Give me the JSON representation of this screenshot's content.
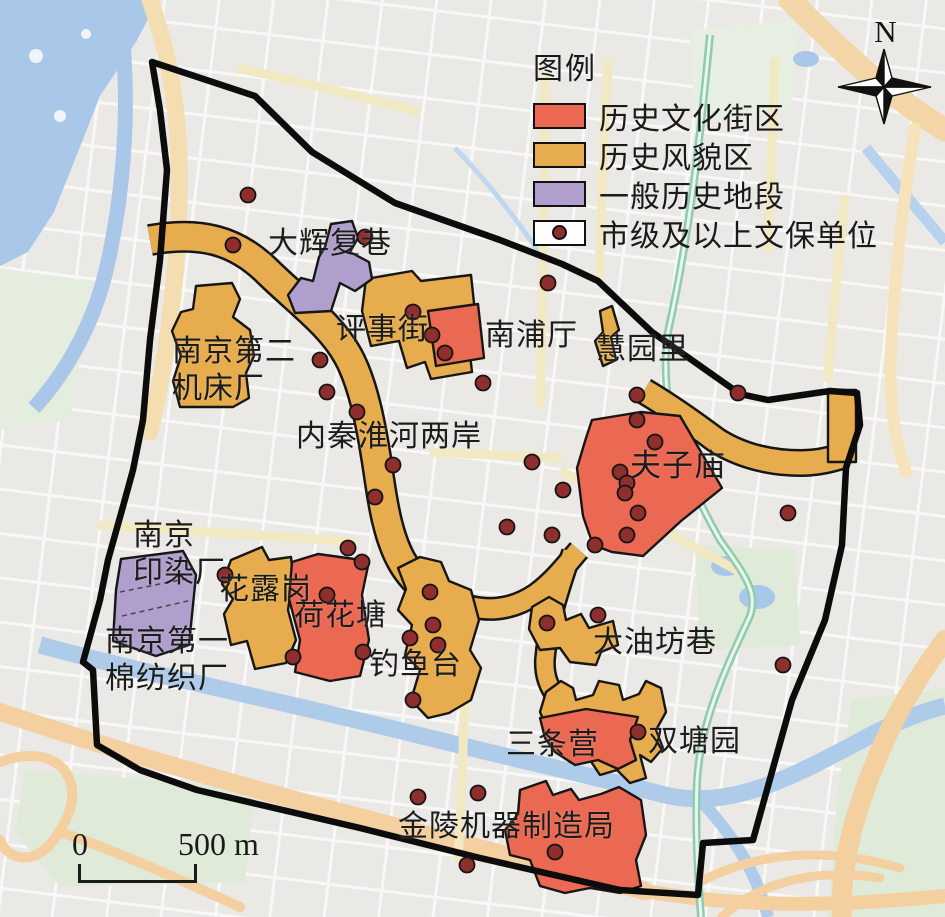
{
  "colors": {
    "historic_block": "#EB6852",
    "historic_style": "#E6AC4D",
    "general_historic": "#B09FCC",
    "heritage_dot": "#8E2F2D"
  },
  "legend": {
    "title": "图例",
    "items": [
      {
        "label": "历史文化街区",
        "color_key": "historic_block",
        "type": "fill"
      },
      {
        "label": "历史风貌区",
        "color_key": "historic_style",
        "type": "fill"
      },
      {
        "label": "一般历史地段",
        "color_key": "general_historic",
        "type": "fill"
      },
      {
        "label": "市级及以上文保单位",
        "color_key": "heritage_dot",
        "type": "dot"
      }
    ]
  },
  "compass": {
    "label": "N"
  },
  "scale_bar": {
    "start": "0",
    "end": "500 m"
  },
  "map": {
    "area_labels": [
      {
        "name": "dahuifuxiang",
        "lines": [
          "大辉复巷"
        ],
        "x": 268,
        "y": 226,
        "size": 30
      },
      {
        "name": "nanjing-no2-machine-tool-works",
        "lines": [
          "南京第二",
          "机床厂"
        ],
        "x": 172,
        "y": 334,
        "size": 30
      },
      {
        "name": "pingshijie",
        "lines": [
          "评事街"
        ],
        "x": 336,
        "y": 312,
        "size": 30
      },
      {
        "name": "nanputing",
        "lines": [
          "南浦厅"
        ],
        "x": 485,
        "y": 318,
        "size": 30
      },
      {
        "name": "huiyuanli",
        "lines": [
          "慧园里"
        ],
        "x": 596,
        "y": 332,
        "size": 30
      },
      {
        "name": "inner-qinhuai-river-banks",
        "lines": [
          "内秦淮河两岸"
        ],
        "x": 296,
        "y": 419,
        "size": 30
      },
      {
        "name": "fuzimiao",
        "lines": [
          "夫子庙"
        ],
        "x": 630,
        "y": 447,
        "size": 31
      },
      {
        "name": "nanjing-dyeing-factory",
        "lines": [
          "南京",
          "印染厂"
        ],
        "x": 133,
        "y": 518,
        "size": 30
      },
      {
        "name": "hualugang",
        "lines": [
          "花露岗"
        ],
        "x": 219,
        "y": 572,
        "size": 30
      },
      {
        "name": "hehuatang",
        "lines": [
          "荷花塘"
        ],
        "x": 294,
        "y": 598,
        "size": 30
      },
      {
        "name": "nanjing-no1-cotton-mill",
        "lines": [
          "南京第一",
          "棉纺织厂"
        ],
        "x": 105,
        "y": 624,
        "size": 30
      },
      {
        "name": "diaoyutai",
        "lines": [
          "钓鱼台"
        ],
        "x": 369,
        "y": 647,
        "size": 30
      },
      {
        "name": "dayoufangxiang",
        "lines": [
          "大油坊巷"
        ],
        "x": 593,
        "y": 625,
        "size": 30
      },
      {
        "name": "santiaoying",
        "lines": [
          "三条营"
        ],
        "x": 506,
        "y": 727,
        "size": 30
      },
      {
        "name": "shuangtangyuan",
        "lines": [
          "双塘园"
        ],
        "x": 648,
        "y": 724,
        "size": 30
      },
      {
        "name": "jinling-machinery-bureau",
        "lines": [
          "金陵机器制造局"
        ],
        "x": 398,
        "y": 809,
        "size": 30
      }
    ],
    "heritage_sites": [
      {
        "x": 248,
        "y": 195
      },
      {
        "x": 233,
        "y": 245
      },
      {
        "x": 365,
        "y": 237
      },
      {
        "x": 548,
        "y": 283
      },
      {
        "x": 413,
        "y": 312
      },
      {
        "x": 432,
        "y": 335
      },
      {
        "x": 445,
        "y": 353
      },
      {
        "x": 320,
        "y": 360
      },
      {
        "x": 327,
        "y": 392
      },
      {
        "x": 357,
        "y": 412
      },
      {
        "x": 483,
        "y": 383
      },
      {
        "x": 393,
        "y": 465
      },
      {
        "x": 375,
        "y": 497
      },
      {
        "x": 532,
        "y": 462
      },
      {
        "x": 563,
        "y": 490
      },
      {
        "x": 348,
        "y": 548
      },
      {
        "x": 362,
        "y": 562
      },
      {
        "x": 507,
        "y": 527
      },
      {
        "x": 552,
        "y": 535
      },
      {
        "x": 637,
        "y": 395
      },
      {
        "x": 738,
        "y": 393
      },
      {
        "x": 637,
        "y": 420
      },
      {
        "x": 655,
        "y": 442
      },
      {
        "x": 620,
        "y": 472
      },
      {
        "x": 627,
        "y": 483
      },
      {
        "x": 625,
        "y": 493
      },
      {
        "x": 638,
        "y": 513
      },
      {
        "x": 627,
        "y": 535
      },
      {
        "x": 595,
        "y": 545
      },
      {
        "x": 788,
        "y": 513
      },
      {
        "x": 225,
        "y": 575
      },
      {
        "x": 327,
        "y": 595
      },
      {
        "x": 293,
        "y": 657
      },
      {
        "x": 363,
        "y": 652
      },
      {
        "x": 430,
        "y": 592
      },
      {
        "x": 433,
        "y": 625
      },
      {
        "x": 410,
        "y": 638
      },
      {
        "x": 438,
        "y": 645
      },
      {
        "x": 547,
        "y": 623
      },
      {
        "x": 598,
        "y": 615
      },
      {
        "x": 783,
        "y": 665
      },
      {
        "x": 638,
        "y": 732
      },
      {
        "x": 413,
        "y": 700
      },
      {
        "x": 418,
        "y": 797
      },
      {
        "x": 478,
        "y": 793
      },
      {
        "x": 555,
        "y": 852
      },
      {
        "x": 467,
        "y": 865
      }
    ]
  }
}
